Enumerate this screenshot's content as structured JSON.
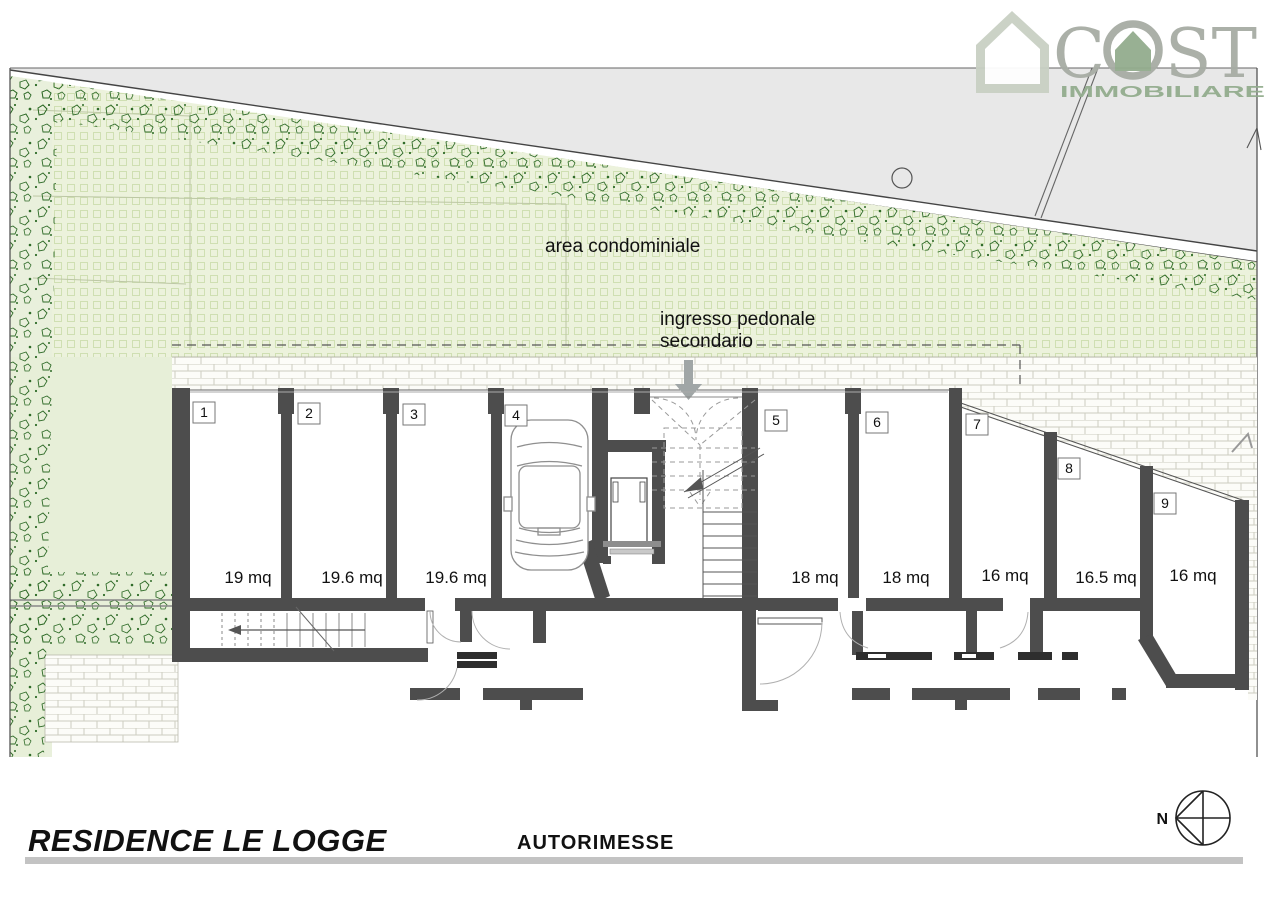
{
  "logo": {
    "brand_c": "C",
    "brand_st": "ST",
    "tagline": "IMMOBILIARE",
    "house_icon_color": "#c9d0c4",
    "brand_color": "#a7aca4",
    "tagline_color": "#93ad8e"
  },
  "plan": {
    "area_condominiale_label": "area condominiale",
    "ingresso_line1": "ingresso pedonale",
    "ingresso_line2": "secondario",
    "garages": [
      {
        "number": "1",
        "area": "19 mq"
      },
      {
        "number": "2",
        "area": "19.6 mq"
      },
      {
        "number": "3",
        "area": "19.6 mq"
      },
      {
        "number": "4",
        "area": ""
      },
      {
        "number": "5",
        "area": "18 mq"
      },
      {
        "number": "6",
        "area": "18 mq"
      },
      {
        "number": "7",
        "area": "16 mq"
      },
      {
        "number": "8",
        "area": "16.5 mq"
      },
      {
        "number": "9",
        "area": "16 mq"
      }
    ]
  },
  "footer": {
    "project_title": "RESIDENCE LE LOGGE",
    "sheet_title": "AUTORIMESSE",
    "compass_north_label": "N"
  },
  "colors": {
    "road": "#e8e8e8",
    "green_area": "#ecf2dc",
    "garden": "#e7efd8",
    "vegetation": "#2f6b28",
    "wall": "#4d4d4d",
    "rule_gray": "#c3c3c3"
  }
}
